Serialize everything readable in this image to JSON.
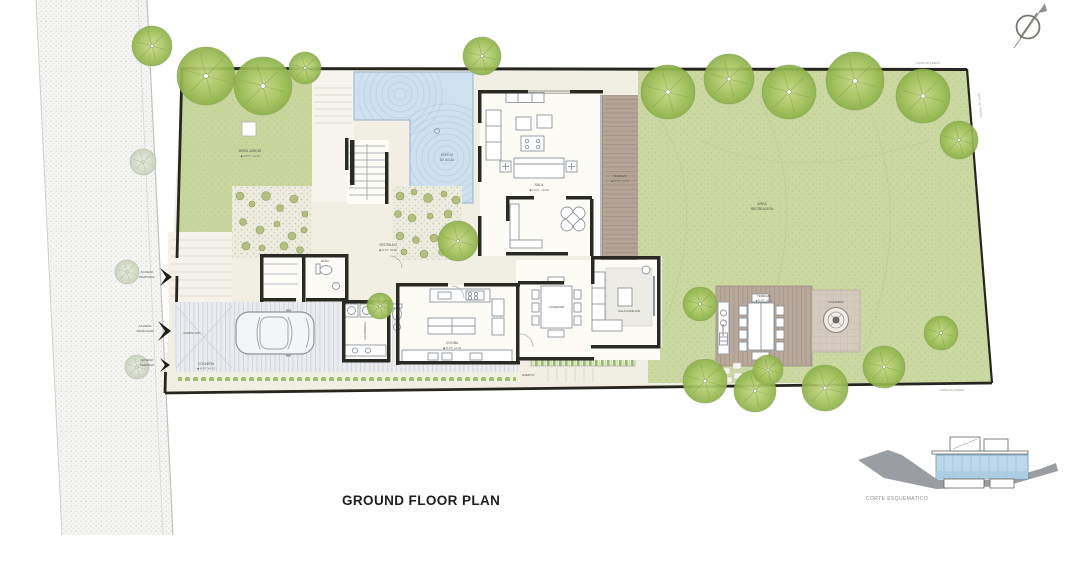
{
  "title": "GROUND FLOOR PLAN",
  "section": {
    "label": "CORTE ESQUEMATICO"
  },
  "site": {
    "garden_left": {
      "name": "AREA JARDIN",
      "level": "◆ N.P.T. +0.15"
    },
    "lawn_l1": "AREA",
    "lawn_l2": "RECREACION",
    "pool_l1": "ESPEJO",
    "pool_l2": "DE AGUA",
    "orchard": "HUERTO",
    "boundary": "LIMITE DE PREDIO"
  },
  "rooms": {
    "sala": {
      "name": "SALA",
      "level": "◆ N.P.T. +0.30"
    },
    "comedor": {
      "name": "COMEDOR"
    },
    "sala_familiar": {
      "name": "SALA FAMILIAR"
    },
    "cocina": {
      "name": "COCINA",
      "level": "◆ N.P.T. +0.30"
    },
    "vestibulo": {
      "name": "VESTIBULO",
      "level": "◆ N.P.T. ±0.00"
    },
    "lavanderia": {
      "name": "LAVANDERIA"
    },
    "bano": {
      "name": "BAÑO"
    },
    "cochera": {
      "name": "COCHERA",
      "level": "◆ N.P.T. +0.15"
    },
    "terraza": {
      "name": "TERRAZA",
      "level": "◆ N.P.T. +0.15"
    },
    "terraza_ext": {
      "name": "TERRAZA",
      "level": "◆ N.P.T. +0.15"
    },
    "fogatero": {
      "name": "FOGATERO"
    },
    "asador": {
      "name": "ASADOR"
    }
  },
  "access": {
    "peatonal_l1": "ACCESO",
    "peatonal_l2": "PEATONAL",
    "vehicular_l1": "ACCESO",
    "vehicular_l2": "VEHICULAR",
    "servicio_l1": "ACCESO",
    "servicio_l2": "SERVICIO",
    "rampa": "RAMPA 15%"
  },
  "colors": {
    "lawn": "#cbd8a2",
    "pool": "#cfe1f0",
    "deck": "#b3a496",
    "wall": "#2a2a24",
    "tree": "#a6c45f"
  },
  "trees": [
    {
      "x": 152,
      "y": 46,
      "r": 20,
      "v": "g"
    },
    {
      "x": 206,
      "y": 76,
      "r": 29,
      "v": "g"
    },
    {
      "x": 263,
      "y": 86,
      "r": 29,
      "v": "g"
    },
    {
      "x": 305,
      "y": 68,
      "r": 16,
      "v": "g"
    },
    {
      "x": 482,
      "y": 56,
      "r": 19,
      "v": "g"
    },
    {
      "x": 143,
      "y": 162,
      "r": 13,
      "v": "s"
    },
    {
      "x": 127,
      "y": 272,
      "r": 12,
      "v": "s"
    },
    {
      "x": 137,
      "y": 367,
      "r": 12,
      "v": "s"
    },
    {
      "x": 458,
      "y": 241,
      "r": 20,
      "v": "g"
    },
    {
      "x": 380,
      "y": 306,
      "r": 13,
      "v": "g"
    },
    {
      "x": 668,
      "y": 92,
      "r": 27,
      "v": "g"
    },
    {
      "x": 729,
      "y": 79,
      "r": 25,
      "v": "g"
    },
    {
      "x": 789,
      "y": 92,
      "r": 27,
      "v": "g"
    },
    {
      "x": 855,
      "y": 81,
      "r": 29,
      "v": "g"
    },
    {
      "x": 923,
      "y": 96,
      "r": 27,
      "v": "g"
    },
    {
      "x": 959,
      "y": 140,
      "r": 19,
      "v": "g"
    },
    {
      "x": 700,
      "y": 304,
      "r": 17,
      "v": "g"
    },
    {
      "x": 705,
      "y": 381,
      "r": 22,
      "v": "g"
    },
    {
      "x": 755,
      "y": 391,
      "r": 21,
      "v": "g"
    },
    {
      "x": 768,
      "y": 370,
      "r": 15,
      "v": "g"
    },
    {
      "x": 825,
      "y": 388,
      "r": 23,
      "v": "g"
    },
    {
      "x": 884,
      "y": 367,
      "r": 21,
      "v": "g"
    },
    {
      "x": 941,
      "y": 333,
      "r": 17,
      "v": "g"
    }
  ]
}
